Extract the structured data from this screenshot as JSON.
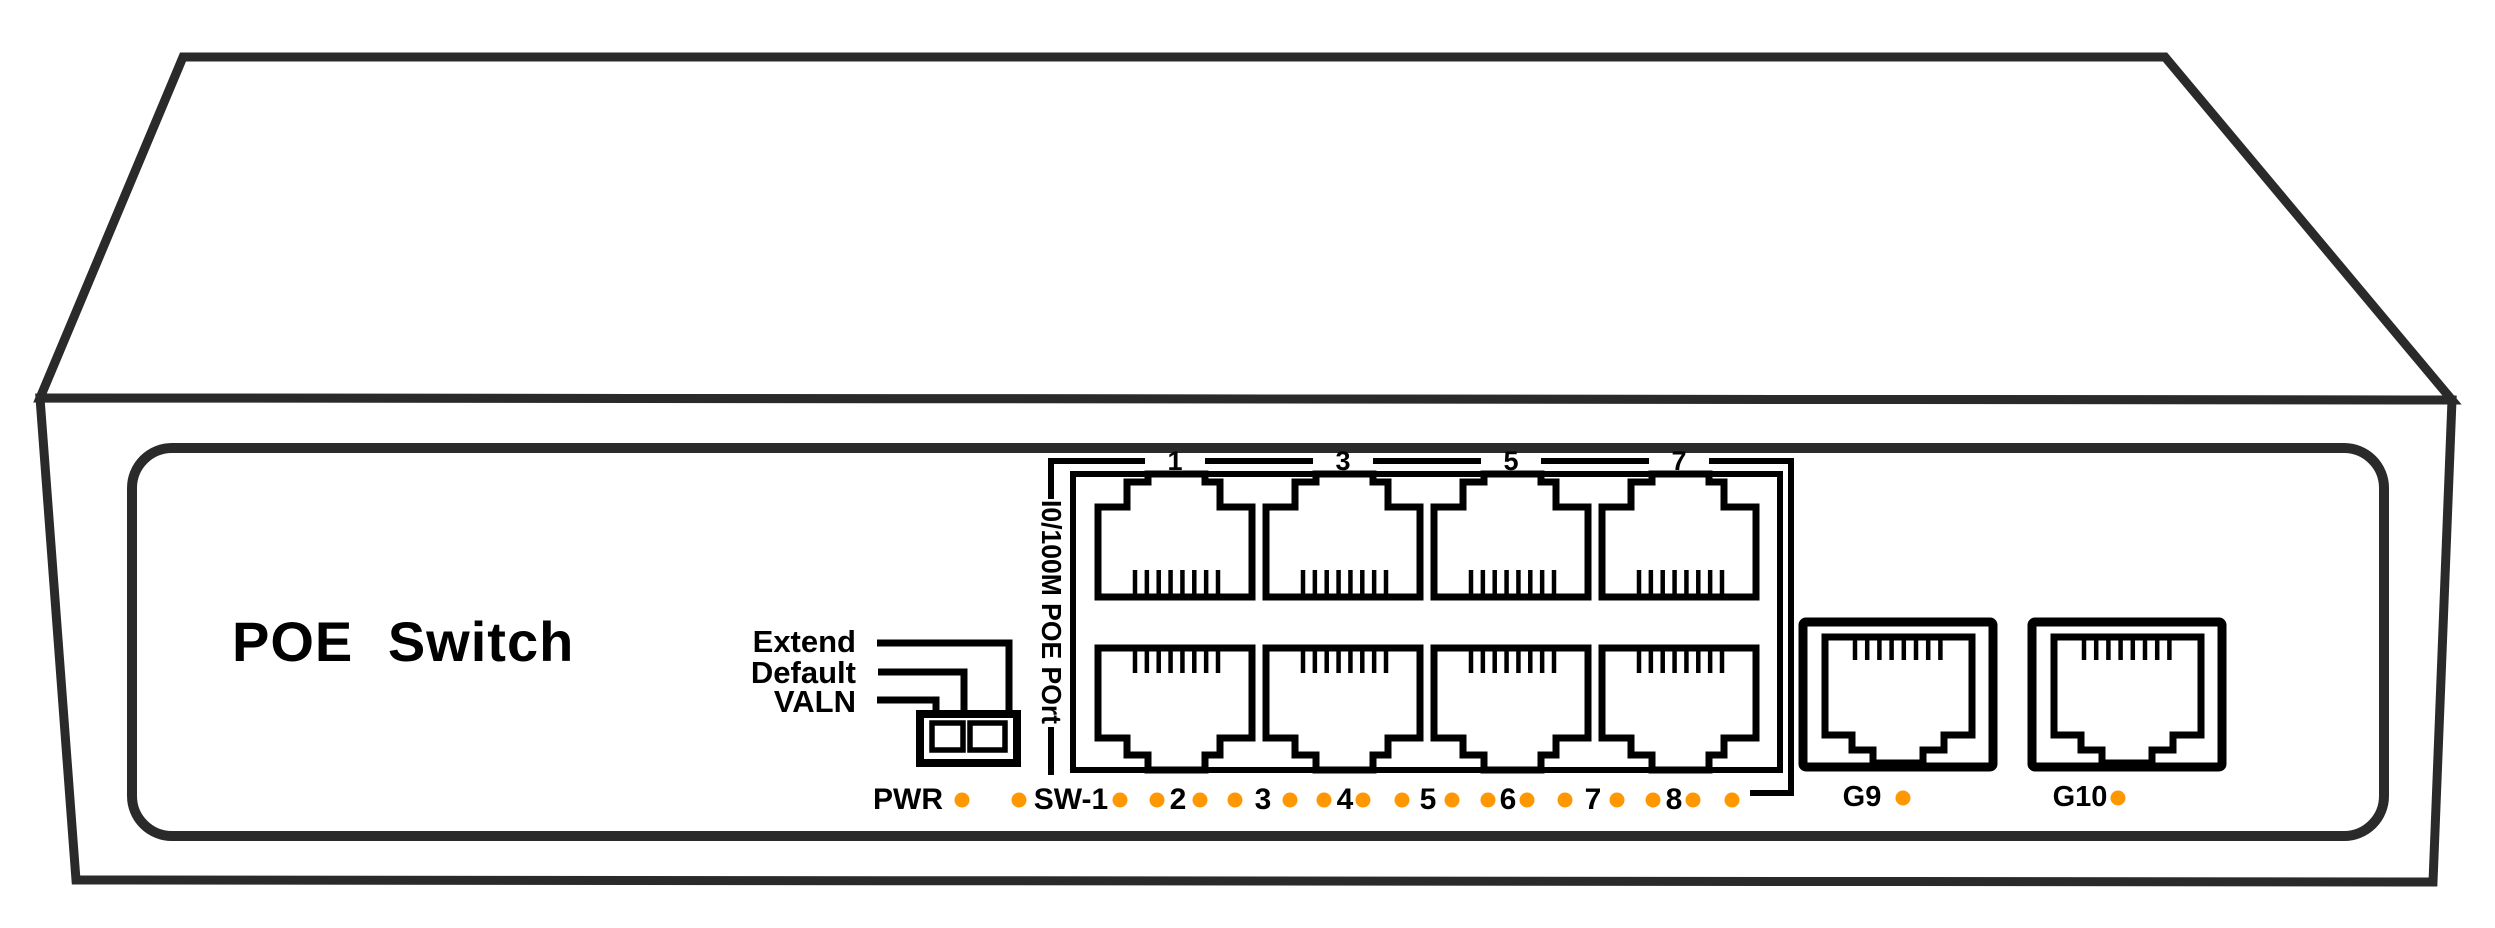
{
  "device": {
    "title": "POE Switch",
    "line_color": "#2a2a2a",
    "detail_color": "#000000",
    "background": "#ffffff"
  },
  "dip_switch": {
    "labels": [
      "Extend",
      "Default",
      "VALN"
    ],
    "positions": 2
  },
  "port_group": {
    "vertical_label": "I0/100M POE POrt",
    "top_port_numbers": [
      "1",
      "3",
      "5",
      "7"
    ],
    "bottom_port_numbers": [
      "2",
      "4",
      "6",
      "8"
    ]
  },
  "led_row": {
    "power_label": "PWR",
    "port_labels": [
      "SW-1",
      "2",
      "3",
      "4",
      "5",
      "6",
      "7",
      "8"
    ],
    "dot_color": "#ff9800"
  },
  "uplink_ports": {
    "labels": [
      "G9",
      "G10"
    ],
    "dot_color": "#ff9800"
  }
}
